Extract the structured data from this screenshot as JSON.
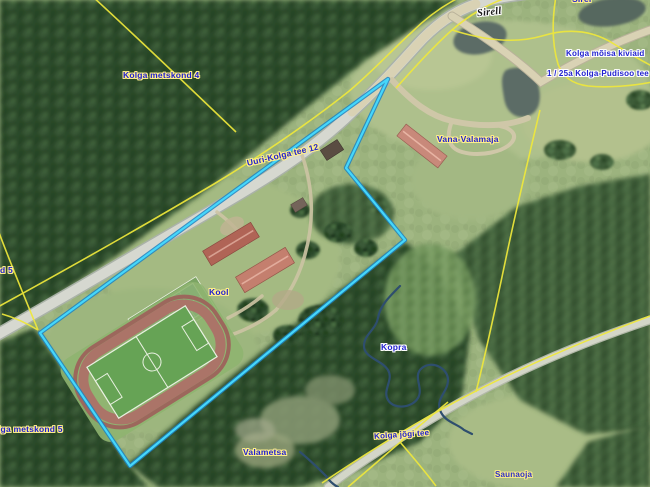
{
  "labels": {
    "sirell": {
      "text": "Sirell"
    },
    "sirel_top": {
      "text": "Sirel"
    },
    "kiviaid": {
      "text": "Kolga mõisa kiviaid"
    },
    "pudisoo": {
      "text": "1 / 25a Kolga-Pudisoo tee"
    },
    "metskond4": {
      "text": "Kolga metskond 4"
    },
    "uuri_kolga": {
      "text": "Uuri-Kolga tee 12"
    },
    "vana_valamaja": {
      "text": "Vana-Valamaja"
    },
    "kool": {
      "text": "Kool"
    },
    "kopra": {
      "text": "Kopra"
    },
    "valametsa": {
      "text": "Valametsa"
    },
    "jogi_tee": {
      "text": "Kolga jõgi tee"
    },
    "saunaoja": {
      "text": "Saunaoja"
    },
    "metskond5_mid": {
      "text": "d 5"
    },
    "metskond5_bot": {
      "text": "lga metskond 5"
    }
  },
  "colors": {
    "parcel_highlight": "#45d7fb",
    "parcel_casing": "#1d84c2",
    "cadastral_line": "#efe83b",
    "label_text": "#2121cf",
    "water": "#2e4e6e"
  }
}
